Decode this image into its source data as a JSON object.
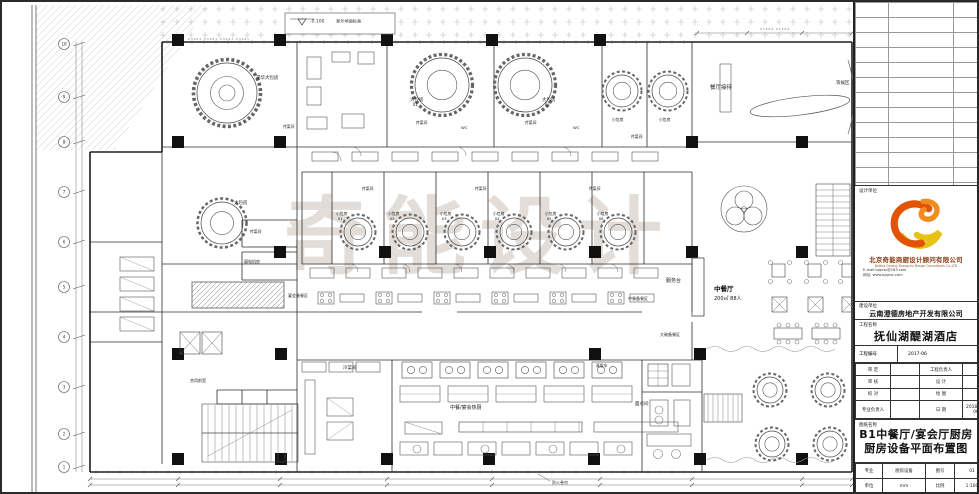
{
  "watermark": "奇能设计",
  "plan": {
    "level_note": {
      "value": "-0.100",
      "label": "室外地面标高"
    },
    "window_tags_left": "C3041 C3041 C3041 C3041",
    "window_tags_right": "C1504 C1504",
    "fire_note": "防火卷帘",
    "axis_left": [
      "10",
      "9",
      "8",
      "7",
      "6",
      "5",
      "4",
      "3",
      "2",
      "1"
    ],
    "restaurant": {
      "name": "中餐厅",
      "capacity": "200㎡ 88人",
      "x": 712,
      "y": 289
    },
    "rooms": [
      {
        "label": "豪华大包房",
        "x": 254,
        "y": 77
      },
      {
        "label": "餐厅接待",
        "x": 708,
        "y": 87,
        "fs": 5.5
      },
      {
        "label": "等候区",
        "x": 834,
        "y": 82
      },
      {
        "label": "大包房",
        "x": 408,
        "y": 99,
        "sub": "01"
      },
      {
        "label": "大包房",
        "x": 540,
        "y": 99,
        "sub": "02"
      },
      {
        "label": "小包房",
        "x": 610,
        "y": 119,
        "fs": 3.8
      },
      {
        "label": "小包房",
        "x": 657,
        "y": 119,
        "fs": 3.8
      },
      {
        "label": "传菜间",
        "x": 281,
        "y": 126,
        "fs": 3.8
      },
      {
        "label": "传菜间",
        "x": 414,
        "y": 122,
        "fs": 3.8
      },
      {
        "label": "传菜间",
        "x": 523,
        "y": 122,
        "fs": 3.8
      },
      {
        "label": "传菜间",
        "x": 629,
        "y": 136,
        "fs": 3.8
      },
      {
        "label": "WC",
        "x": 459,
        "y": 127,
        "fs": 3.8
      },
      {
        "label": "WC",
        "x": 571,
        "y": 127,
        "fs": 3.8
      },
      {
        "label": "传菜间",
        "x": 360,
        "y": 188,
        "fs": 3.8
      },
      {
        "label": "传菜间",
        "x": 473,
        "y": 188,
        "fs": 3.8
      },
      {
        "label": "传菜间",
        "x": 587,
        "y": 188,
        "fs": 3.8
      },
      {
        "label": "小包房",
        "x": 334,
        "y": 213,
        "sub": "01",
        "fs": 3.8
      },
      {
        "label": "小包房",
        "x": 386,
        "y": 213,
        "sub": "02",
        "fs": 3.8
      },
      {
        "label": "小包房",
        "x": 438,
        "y": 213,
        "sub": "03",
        "fs": 3.8
      },
      {
        "label": "小包房",
        "x": 491,
        "y": 213,
        "sub": "04",
        "fs": 3.8
      },
      {
        "label": "小包房",
        "x": 543,
        "y": 213,
        "sub": "05",
        "fs": 3.8
      },
      {
        "label": "小包房",
        "x": 595,
        "y": 213,
        "sub": "06",
        "fs": 3.8
      },
      {
        "label": "大包房",
        "x": 232,
        "y": 202
      },
      {
        "label": "传菜间",
        "x": 248,
        "y": 231,
        "fs": 3.8
      },
      {
        "label": "弱电机房",
        "x": 242,
        "y": 261,
        "fs": 4
      },
      {
        "label": "宴会备餐区",
        "x": 286,
        "y": 295,
        "fs": 4
      },
      {
        "label": "服务台",
        "x": 664,
        "y": 280,
        "fs": 5
      },
      {
        "label": "中餐备餐区",
        "x": 626,
        "y": 298,
        "fs": 4
      },
      {
        "label": "大碗备餐区",
        "x": 658,
        "y": 334,
        "fs": 4
      },
      {
        "label": "冷菜间",
        "x": 341,
        "y": 367
      },
      {
        "label": "蒸饭车",
        "x": 594,
        "y": 365,
        "fs": 3.8
      },
      {
        "label": "中餐/宴会热厨",
        "x": 448,
        "y": 407,
        "fs": 5
      },
      {
        "label": "面点间",
        "x": 633,
        "y": 403
      },
      {
        "label": "合用前室",
        "x": 188,
        "y": 380,
        "fs": 4
      }
    ]
  },
  "title_block": {
    "design_unit_label": "设计单位",
    "company_cn": "北京奇能商厨设计顾问有限公司",
    "company_en": "Beijing Qineng Shangchu Design Consultants Co.,LTD",
    "email": "E-mail:bjqnsc@163.com",
    "website": "网址: www.bjqnsc.com",
    "client_label": "建设单位",
    "client": "云南澄德房地产开发有限公司",
    "project_label": "工程名称",
    "project": "抚仙湖醍湖酒店",
    "project_no_label": "工程编号",
    "project_no": "2017-06",
    "personnel": [
      {
        "l1": "审 定",
        "v1": "",
        "l2": "工程负责人",
        "v2": ""
      },
      {
        "l1": "审 核",
        "v1": "",
        "l2": "设 计",
        "v2": ""
      },
      {
        "l1": "校 对",
        "v1": "",
        "l2": "绘 图",
        "v2": ""
      },
      {
        "l1": "专业负责人",
        "v1": "",
        "l2": "日 期",
        "v2": "2018-01-06"
      }
    ],
    "drawing_name_label": "图纸名称",
    "drawing_name_line1": "B1中餐厅/宴会厅厨房",
    "drawing_name_line2": "厨房设备平面布置图",
    "footer": [
      {
        "l1": "专业",
        "v1": "厨房设备",
        "l2": "图号",
        "v2": "01"
      },
      {
        "l1": "单位",
        "v1": "mm",
        "l2": "比例",
        "v2": "1:100"
      }
    ]
  }
}
